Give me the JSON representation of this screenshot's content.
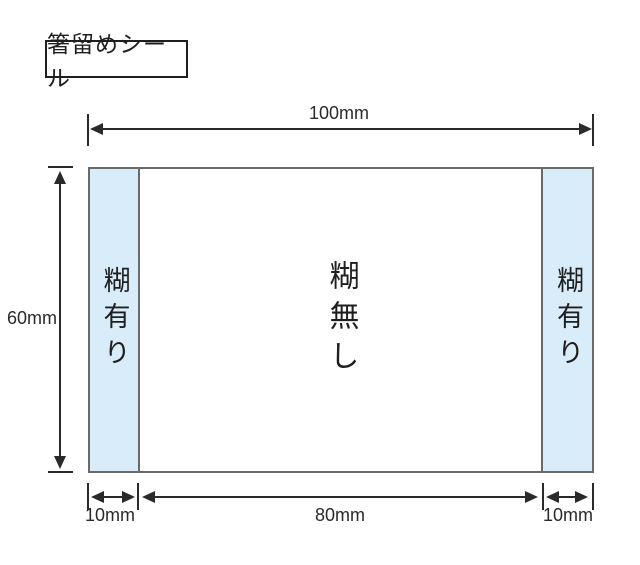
{
  "title": "箸留めシール",
  "sheet": {
    "areas": {
      "left": "糊有り",
      "center": "糊無し",
      "right": "糊有り"
    }
  },
  "dimensions": {
    "total_width": "100mm",
    "height": "60mm",
    "left_glue_width": "10mm",
    "no_glue_width": "80mm",
    "right_glue_width": "10mm"
  },
  "colors": {
    "glue_area_fill": "#d8ecfa",
    "sheet_outline": "#6a6a6a",
    "dimension_ink": "#2a2a2a"
  }
}
